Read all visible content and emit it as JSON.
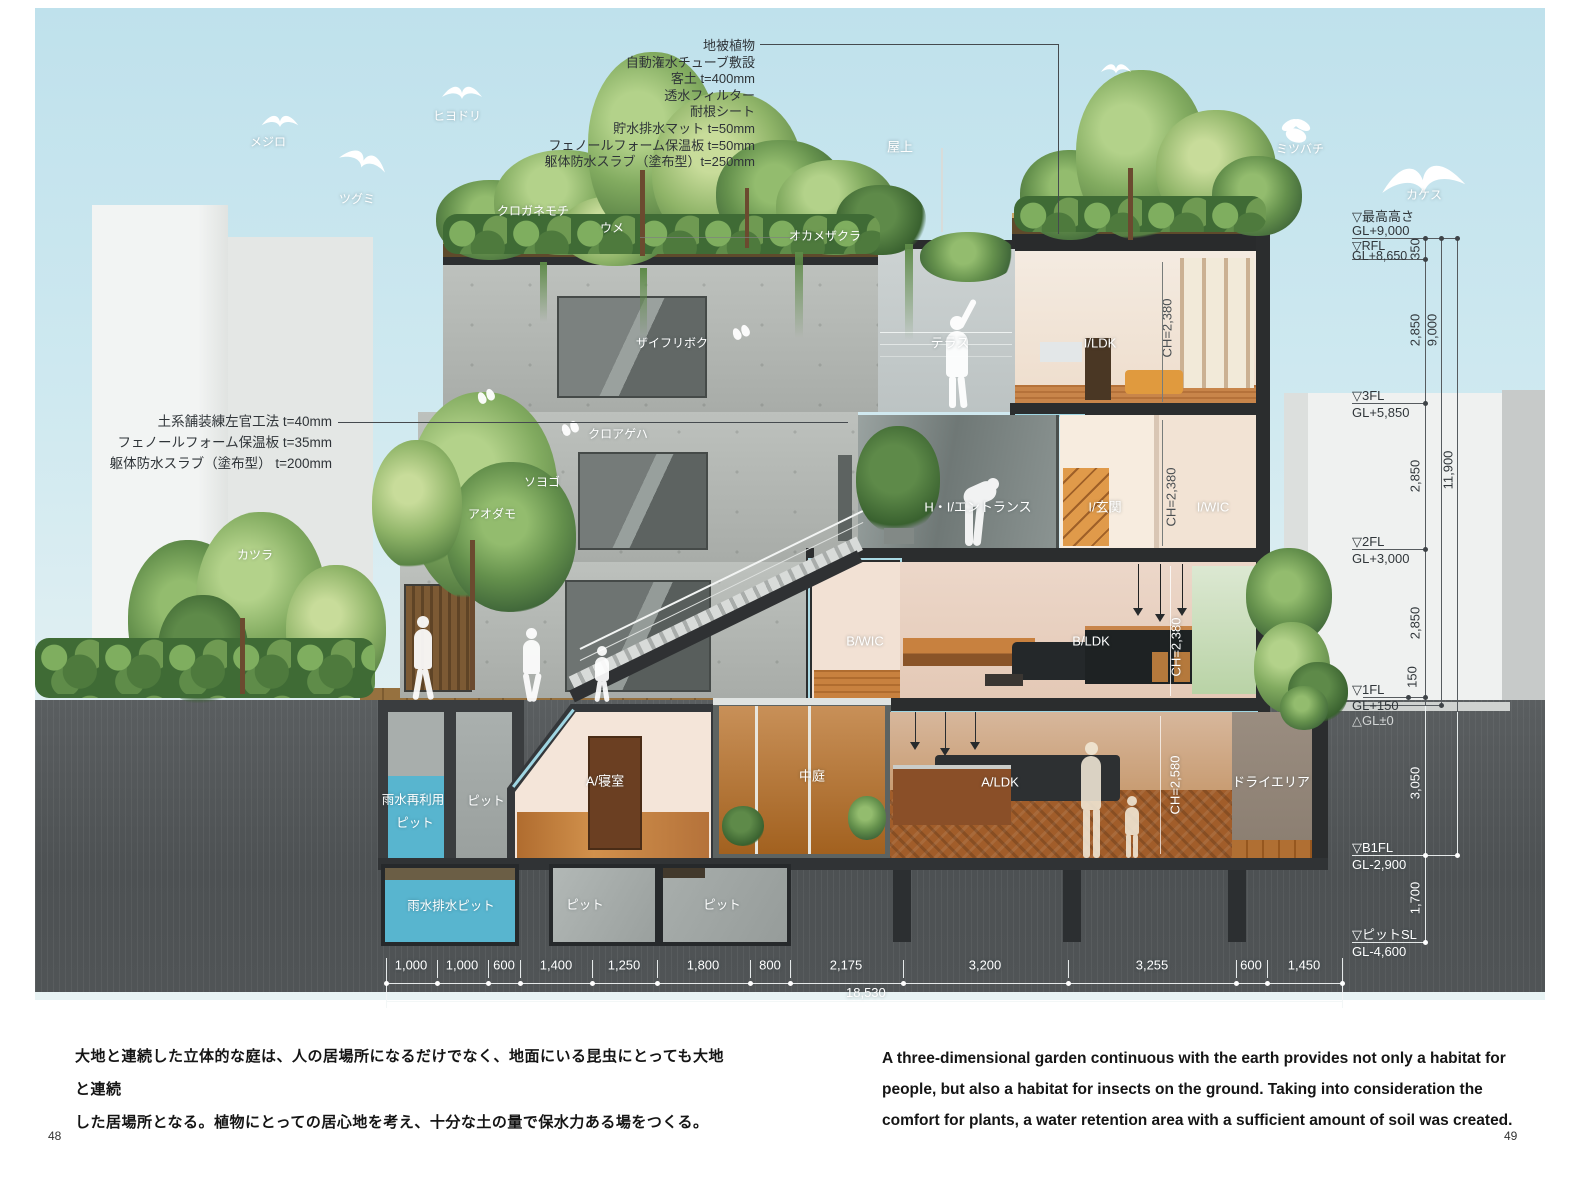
{
  "page": {
    "left_number": "48",
    "right_number": "49"
  },
  "captions": {
    "jp": [
      "大地と連続した立体的な庭は、人の居場所になるだけでなく、地面にいる昆虫にとっても大地と連続",
      "した居場所となる。植物にとっての居心地を考え、十分な土の量で保水力ある場をつくる。"
    ],
    "en": [
      "A three-dimensional garden continuous with the earth provides not only a habitat for",
      "people, but also a habitat for insects on the ground. Taking into consideration the",
      "comfort for plants, a water retention area with a sufficient amount of soil was created."
    ]
  },
  "annotations": {
    "roof_layers": [
      "地被植物",
      "自動潅水チューブ敷設",
      "客土 t=400mm",
      "透水フィルター",
      "耐根シート",
      "貯水排水マット t=50mm",
      "フェノールフォーム保温板 t=50mm",
      "躯体防水スラブ（塗布型）t=250mm"
    ],
    "terrace_layers": [
      "土系舗装練左官工法 t=40mm",
      "フェノールフォーム保温板 t=35mm",
      "躯体防水スラブ（塗布型） t=200mm"
    ]
  },
  "levels": {
    "saikou": {
      "name": "▽最高高さ",
      "gl": "GL+9,000"
    },
    "rfl": {
      "name": "▽RFL",
      "gl": "GL+8,650"
    },
    "f3": {
      "name": "▽3FL",
      "gl": "GL+5,850"
    },
    "f2": {
      "name": "▽2FL",
      "gl": "GL+3,000"
    },
    "f1": {
      "name": "▽1FL",
      "gl": "GL+150"
    },
    "gl0": {
      "name": "△GL±0"
    },
    "b1": {
      "name": "▽B1FL",
      "gl": "GL-2,900"
    },
    "pitsl": {
      "name": "▽ピットSL",
      "gl": "GL-4,600"
    }
  },
  "dims": {
    "vertical": {
      "s350": "350",
      "s2850": "2,850",
      "s150": "150",
      "s3050": "3,050",
      "s1700": "1,700",
      "o9000": "9,000",
      "o11900": "11,900"
    },
    "horizontal": {
      "segments": [
        "1,000",
        "1,000",
        "600",
        "1,400",
        "1,250",
        "1,800",
        "800",
        "2,175",
        "3,200",
        "3,255",
        "600",
        "1,450"
      ],
      "total": "18,530"
    }
  },
  "rooms": {
    "rooftop": "屋上",
    "terrace": "テラス",
    "i_ldk": "I/LDK",
    "ch_2380": "CH=2,380",
    "entrance": "H・I/エントランス",
    "i_genkan": "I/玄関",
    "i_wic": "I/WIC",
    "b_wic": "B/WIC",
    "b_ldk": "B/LDK",
    "a_bedroom": "A/寝室",
    "courtyard": "中庭",
    "a_ldk": "A/LDK",
    "ch_2580": "CH=2,580",
    "dry_area": "ドライエリア",
    "rain_reuse_pit_line1": "雨水再利用",
    "rain_reuse_pit_line2": "ピット",
    "pit": "ピット",
    "rain_drain_pit": "雨水排水ピット"
  },
  "wildlife": {
    "mejiro": "メジロ",
    "tsugumi": "ツグミ",
    "hiyodori": "ヒヨドリ",
    "mitsubachi": "ミツバチ",
    "kakesu": "カケス",
    "kuroageha": "クロアゲハ"
  },
  "plants": {
    "kuroganemochi": "クロガネモチ",
    "ume": "ウメ",
    "okamezakura": "オカメザクラ",
    "zaifuriboku": "ザイフリボク",
    "soyogo": "ソヨゴ",
    "aodamo": "アオダモ",
    "katsura": "カツラ"
  }
}
